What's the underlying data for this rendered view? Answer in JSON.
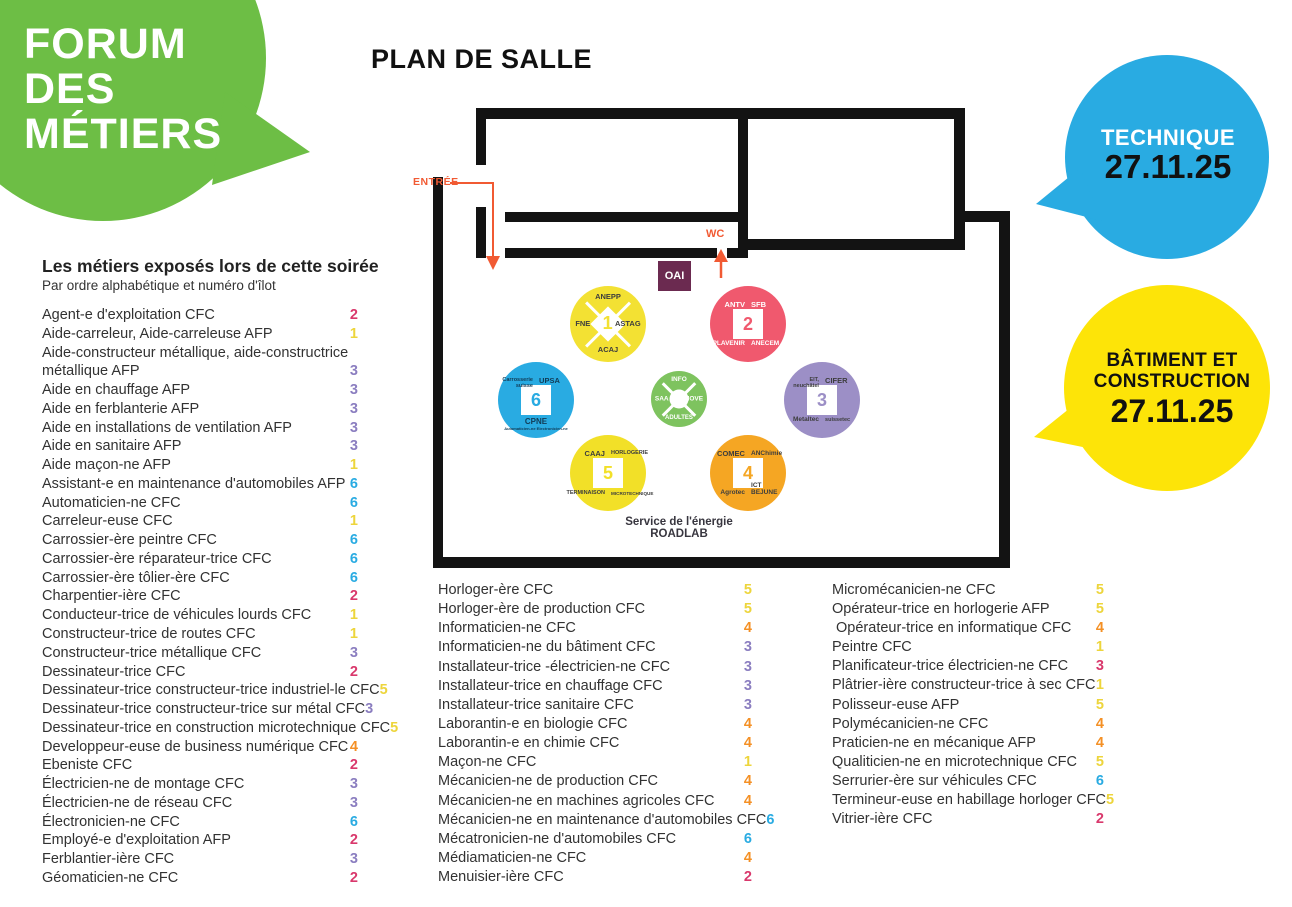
{
  "brand": {
    "lines": [
      "FORUM",
      "DES",
      "MÉTIERS"
    ],
    "color": "#6DBE45"
  },
  "title": "PLAN DE SALLE",
  "bubbles": {
    "technique": {
      "label": "TECHNIQUE",
      "date": "27.11.25",
      "color": "#29ABE2"
    },
    "batiment": {
      "line1": "BÂTIMENT ET",
      "line2": "CONSTRUCTION",
      "date": "27.11.25",
      "color": "#FDE408"
    }
  },
  "plan": {
    "entrance_label": "ENTRÉE",
    "wc_label": "WC",
    "oai_label": "OAI",
    "oai_color": "#6B2A50",
    "arrow_color": "#F15A33",
    "service_line1": "Service de l'énergie",
    "service_line2": "ROADLAB",
    "stands": [
      {
        "num": "1",
        "color": "#F3E133",
        "shape": "diamond",
        "text_color": "#3D3D3D",
        "cx": 608,
        "cy": 324,
        "r": 38,
        "labels": {
          "top": "ANEPP",
          "left": "FNE",
          "right": "ASTAG",
          "bottom": "ACAJ"
        }
      },
      {
        "num": "2",
        "color": "#F0596E",
        "shape": "square",
        "text_color": "#FFFFFF",
        "cx": 748,
        "cy": 324,
        "r": 38,
        "labels": {
          "tl": "ANTV",
          "tr": "SFB",
          "bl": "PLAVENIR",
          "br": "ANECEM"
        }
      },
      {
        "num": "3",
        "color": "#9C8FC6",
        "shape": "square",
        "text_color": "#3D3D3D",
        "cx": 822,
        "cy": 400,
        "r": 38,
        "labels": {
          "tl": "EIT,\nneuchâtel",
          "tr": "CIFER",
          "bl": "Metaltec",
          "br": "suissetec"
        }
      },
      {
        "num": "4",
        "color": "#F5A623",
        "shape": "square",
        "text_color": "#3D3D3D",
        "cx": 748,
        "cy": 473,
        "r": 38,
        "labels": {
          "tl": "COMEC",
          "tr": "ANChimie",
          "bl": "Agrotec",
          "br": "ICT\nBEJUNE"
        }
      },
      {
        "num": "5",
        "color": "#F2E028",
        "shape": "square",
        "text_color": "#3D3D3D",
        "cx": 608,
        "cy": 473,
        "r": 38,
        "labels": {
          "tl": "CAAJ",
          "tr": "HORLOGERIE",
          "bl": "TERMINAISON",
          "br": "MICROTECHNIQUE"
        }
      },
      {
        "num": "6",
        "color": "#29ABE2",
        "shape": "square",
        "text_color": "#123B55",
        "cx": 536,
        "cy": 400,
        "r": 38,
        "labels": {
          "tl": "Carrosserie\nsuisse",
          "tr": "UPSA",
          "b": "CPNE",
          "b_sub": "Automaticien-ne   Electronicien-ne"
        }
      }
    ],
    "info_stand": {
      "color": "#7EC35F",
      "text_color": "#FFFFFF",
      "cx": 679,
      "cy": 399,
      "r": 28,
      "labels": {
        "top": "INFO",
        "left": "SAA",
        "right": "MOVE",
        "bottom": "ADULTES"
      }
    }
  },
  "number_colors": {
    "yellow": "#EDD53C",
    "pink": "#D9386C",
    "purple": "#8B7EC0",
    "orange": "#F49025",
    "blue": "#29ABE2"
  },
  "list": {
    "title": "Les métiers exposés lors de cette soirée",
    "subtitle": "Par ordre alphabétique et numéro d'îlot",
    "columns": [
      [
        {
          "label": "Agent-e d'exploitation CFC",
          "num": "2",
          "color": "pink"
        },
        {
          "label": "Aide-carreleur, Aide-carreleuse AFP",
          "num": "1",
          "color": "yellow"
        },
        {
          "label": "Aide-constructeur métallique, aide-constructrice",
          "num": "",
          "color": ""
        },
        {
          "label": "métallique AFP",
          "num": "3",
          "color": "purple"
        },
        {
          "label": "Aide en chauffage AFP",
          "num": "3",
          "color": "purple"
        },
        {
          "label": "Aide en ferblanterie AFP",
          "num": "3",
          "color": "purple"
        },
        {
          "label": "Aide en installations de ventilation AFP",
          "num": "3",
          "color": "purple"
        },
        {
          "label": "Aide en sanitaire AFP",
          "num": "3",
          "color": "purple"
        },
        {
          "label": "Aide maçon-ne AFP",
          "num": "1",
          "color": "yellow"
        },
        {
          "label": "Assistant-e en maintenance d'automobiles AFP",
          "num": "6",
          "color": "blue"
        },
        {
          "label": "Automaticien-ne CFC",
          "num": "6",
          "color": "blue"
        },
        {
          "label": "Carreleur-euse CFC",
          "num": "1",
          "color": "yellow"
        },
        {
          "label": "Carrossier-ère peintre CFC",
          "num": "6",
          "color": "blue"
        },
        {
          "label": "Carrossier-ère réparateur-trice CFC",
          "num": "6",
          "color": "blue"
        },
        {
          "label": "Carrossier-ère tôlier-ère CFC",
          "num": "6",
          "color": "blue"
        },
        {
          "label": "Charpentier-ière CFC",
          "num": "2",
          "color": "pink"
        },
        {
          "label": "Conducteur-trice de véhicules lourds CFC",
          "num": "1",
          "color": "yellow"
        },
        {
          "label": "Constructeur-trice de routes CFC",
          "num": "1",
          "color": "yellow"
        },
        {
          "label": "Constructeur-trice métallique CFC",
          "num": "3",
          "color": "purple"
        },
        {
          "label": "Dessinateur-trice CFC",
          "num": "2",
          "color": "pink"
        },
        {
          "label": "Dessinateur-trice constructeur-trice industriel-le CFC",
          "num": "5",
          "color": "yellow"
        },
        {
          "label": "Dessinateur-trice constructeur-trice sur métal CFC",
          "num": "3",
          "color": "purple"
        },
        {
          "label": "Dessinateur-trice en construction microtechnique CFC",
          "num": "5",
          "color": "yellow"
        },
        {
          "label": "Developpeur-euse de business numérique CFC",
          "num": "4",
          "color": "orange"
        },
        {
          "label": "Ebeniste CFC",
          "num": "2",
          "color": "pink"
        },
        {
          "label": "Électricien-ne de montage CFC",
          "num": "3",
          "color": "purple"
        },
        {
          "label": "Électricien-ne de réseau CFC",
          "num": "3",
          "color": "purple"
        },
        {
          "label": "Électronicien-ne CFC",
          "num": "6",
          "color": "blue"
        },
        {
          "label": "Employé-e d'exploitation AFP",
          "num": "2",
          "color": "pink"
        },
        {
          "label": "Ferblantier-ière CFC",
          "num": "3",
          "color": "purple"
        },
        {
          "label": "Géomaticien-ne CFC",
          "num": "2",
          "color": "pink"
        }
      ],
      [
        {
          "label": "Horloger-ère CFC",
          "num": "5",
          "color": "yellow"
        },
        {
          "label": "Horloger-ère de production CFC",
          "num": "5",
          "color": "yellow"
        },
        {
          "label": "Informaticien-ne CFC",
          "num": "4",
          "color": "orange"
        },
        {
          "label": "Informaticien-ne du bâtiment CFC",
          "num": "3",
          "color": "purple"
        },
        {
          "label": "Installateur-trice -électricien-ne CFC",
          "num": "3",
          "color": "purple"
        },
        {
          "label": "Installateur-trice en chauffage CFC",
          "num": "3",
          "color": "purple"
        },
        {
          "label": "Installateur-trice sanitaire CFC",
          "num": "3",
          "color": "purple"
        },
        {
          "label": "Laborantin-e en biologie CFC",
          "num": "4",
          "color": "orange"
        },
        {
          "label": "Laborantin-e en chimie CFC",
          "num": "4",
          "color": "orange"
        },
        {
          "label": "Maçon-ne CFC",
          "num": "1",
          "color": "yellow"
        },
        {
          "label": "Mécanicien-ne de production CFC",
          "num": "4",
          "color": "orange"
        },
        {
          "label": "Mécanicien-ne en machines agricoles CFC",
          "num": "4",
          "color": "orange"
        },
        {
          "label": "Mécanicien-ne en maintenance d'automobiles CFC",
          "num": "6",
          "color": "blue"
        },
        {
          "label": "Mécatronicien-ne d'automobiles CFC",
          "num": "6",
          "color": "blue"
        },
        {
          "label": "Médiamaticien-ne CFC",
          "num": "4",
          "color": "orange"
        },
        {
          "label": "Menuisier-ière CFC",
          "num": "2",
          "color": "pink"
        }
      ],
      [
        {
          "label": "Micromécanicien-ne CFC",
          "num": "5",
          "color": "yellow"
        },
        {
          "label": "Opérateur-trice en horlogerie AFP",
          "num": "5",
          "color": "yellow"
        },
        {
          "label": " Opérateur-trice en informatique CFC",
          "num": "4",
          "color": "orange"
        },
        {
          "label": "Peintre CFC",
          "num": "1",
          "color": "yellow"
        },
        {
          "label": "Planificateur-trice électricien-ne CFC",
          "num": "3",
          "color": "pink"
        },
        {
          "label": "Plâtrier-ière constructeur-trice à sec CFC",
          "num": "1",
          "color": "yellow"
        },
        {
          "label": "Polisseur-euse AFP",
          "num": "5",
          "color": "yellow"
        },
        {
          "label": "Polymécanicien-ne CFC",
          "num": "4",
          "color": "orange"
        },
        {
          "label": "Praticien-ne en mécanique AFP",
          "num": "4",
          "color": "orange"
        },
        {
          "label": "Qualiticien-ne en microtechnique CFC",
          "num": "5",
          "color": "yellow"
        },
        {
          "label": "Serrurier-ère sur véhicules CFC",
          "num": "6",
          "color": "blue"
        },
        {
          "label": "Termineur-euse en habillage horloger CFC",
          "num": "5",
          "color": "yellow"
        },
        {
          "label": "Vitrier-ière CFC",
          "num": "2",
          "color": "pink"
        }
      ]
    ]
  }
}
